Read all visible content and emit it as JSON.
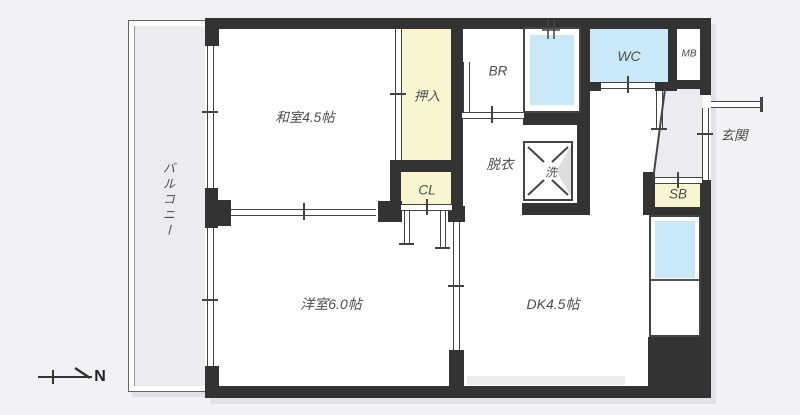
{
  "floorplan": {
    "rooms": {
      "balcony": {
        "label": "バルコニー"
      },
      "washitsu": {
        "label": "和室4.5帖"
      },
      "oshiire": {
        "label": "押入"
      },
      "closet": {
        "label": "CL"
      },
      "bath": {
        "label": "BR"
      },
      "datsui": {
        "label": "脱衣"
      },
      "laundry": {
        "label": "洗"
      },
      "wc": {
        "label": "WC"
      },
      "mb": {
        "label": "MB"
      },
      "genkan": {
        "label": "玄関"
      },
      "shoebox": {
        "label": "SB"
      },
      "yoshitsu": {
        "label": "洋室6.0帖"
      },
      "dk": {
        "label": "DK4.5帖"
      }
    },
    "compass": {
      "label": "N"
    },
    "colors": {
      "wall": "#333333",
      "storage_yellow": "#f8f6d0",
      "water_blue": "#c9e9f8",
      "gray_area": "#ececee",
      "background": "#f2f2f4",
      "line": "#444444"
    }
  }
}
